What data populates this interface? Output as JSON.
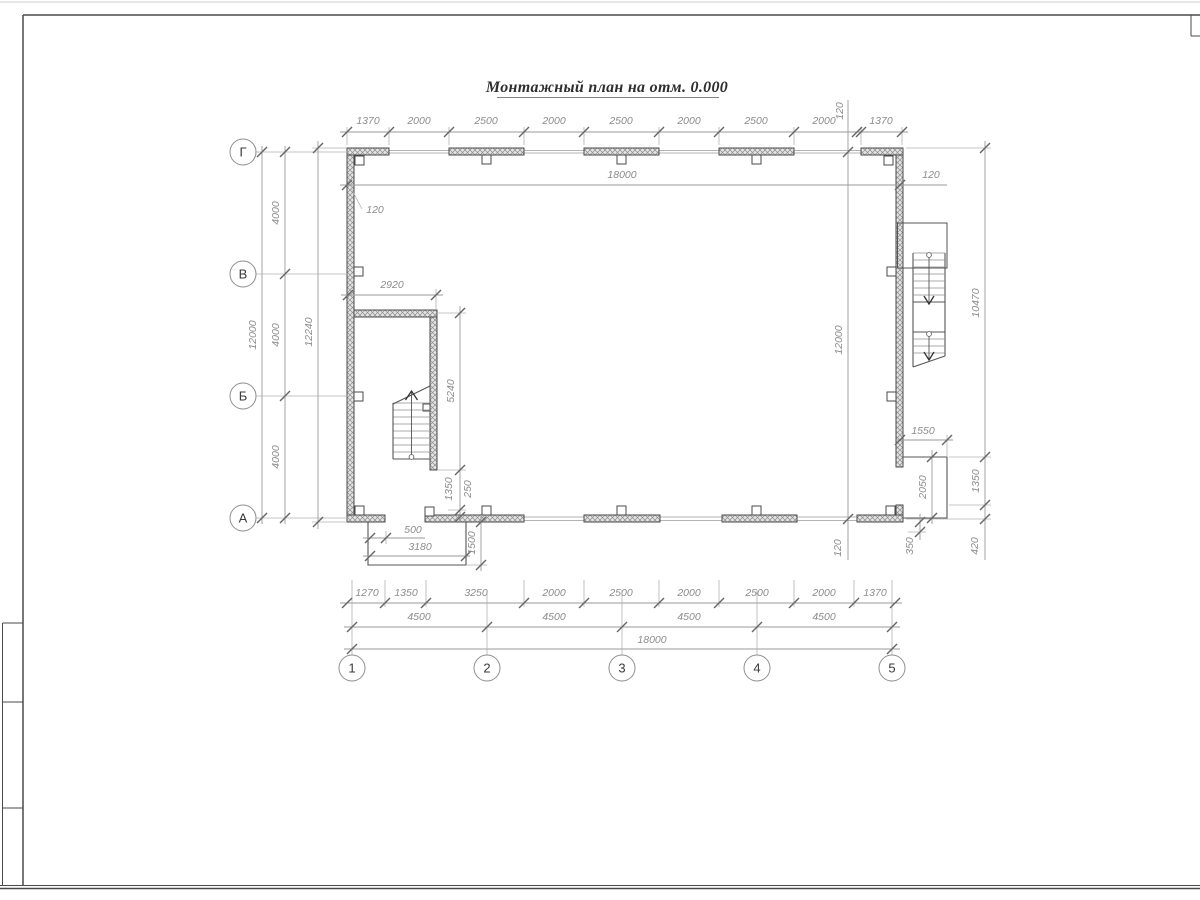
{
  "title": "Монтажный план на отм. 0.000",
  "axes": {
    "rows": [
      "Г",
      "В",
      "Б",
      "А"
    ],
    "cols": [
      "1",
      "2",
      "3",
      "4",
      "5"
    ]
  },
  "dims": {
    "top_chain": [
      "1370",
      "2000",
      "2500",
      "2000",
      "2500",
      "2000",
      "2500",
      "2000",
      "1370"
    ],
    "top_total": "18000",
    "top_total_right": "120",
    "top_left_thickness": "120",
    "inner_thickness_top": "120",
    "inner_height": "12000",
    "inner_thickness_bottom": "120",
    "left_bays": [
      "4000",
      "4000",
      "4000"
    ],
    "left_total": "12000",
    "left_overall": "12240",
    "partition_width": "2920",
    "partition_length": "5240",
    "partition_door": "1350",
    "partition_pier": "250",
    "porch_left_step": "500",
    "porch_left_width": "3180",
    "porch_left_depth": "1500",
    "porch_right_width": "1550",
    "porch_right_depth": "2050",
    "porch_right_offset": "350",
    "right_height": "10470",
    "right_door": "1350",
    "right_offset": "420",
    "bottom_chain": [
      "1270",
      "1350",
      "3250",
      "2000",
      "2500",
      "2000",
      "2500",
      "2000",
      "1370"
    ],
    "bottom_bays": [
      "4500",
      "4500",
      "4500",
      "4500"
    ],
    "bottom_total": "18000"
  }
}
